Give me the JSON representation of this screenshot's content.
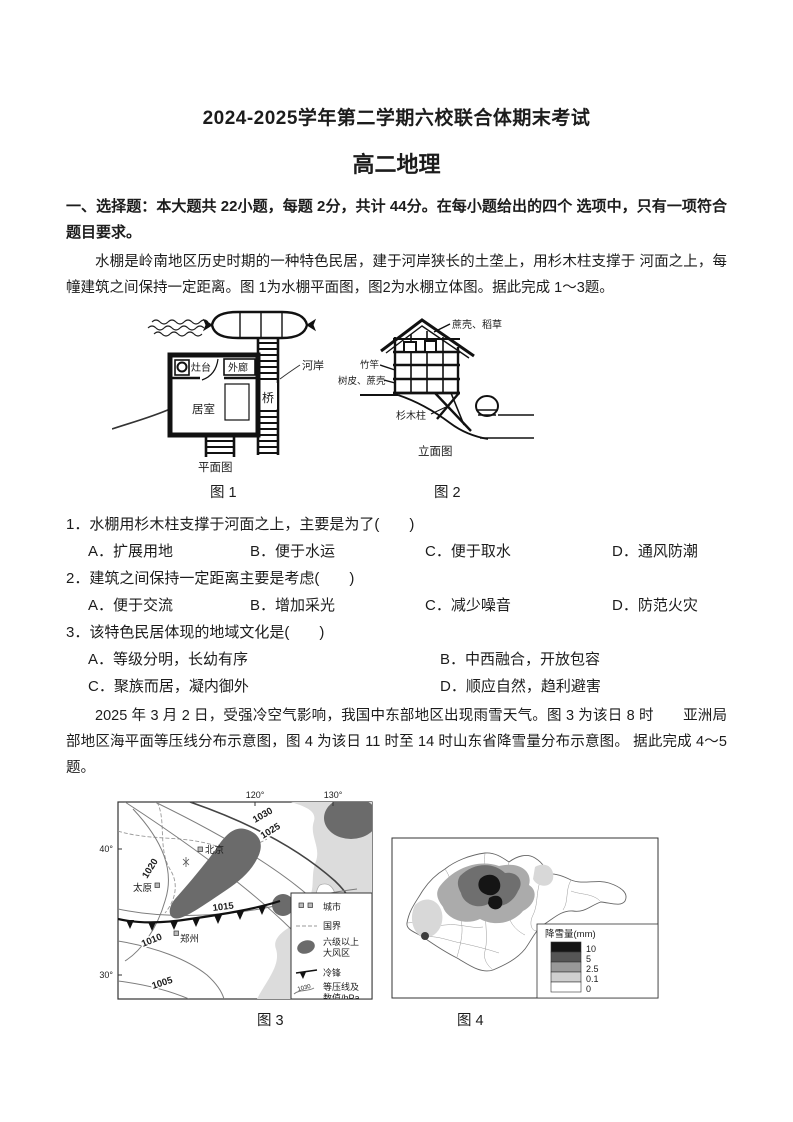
{
  "header": {
    "title": "2024-2025学年第二学期六校联合体期末考试",
    "subtitle": "高二地理"
  },
  "section1": {
    "heading": "一、选择题：本大题共 22小题，每题 2分，共计 44分。在每小题给出的四个 选项中，只有一项符合题目要求。"
  },
  "passage1": "水棚是岭南地区历史时期的一种特色民居，建于河岸狭长的土垄上，用杉木柱支撑于  河面之上，每幢建筑之间保持一定距离。图 1为水棚平面图，图2为水棚立体图。据此完成 1～3题。",
  "figure1": {
    "caption": "图 1",
    "label_stove": "灶台",
    "label_corridor": "外廊",
    "label_room": "居室",
    "label_riverbank": "河岸",
    "label_bridge": "桥",
    "label_view": "平面图"
  },
  "figure2": {
    "caption": "图 2",
    "label_roof": "蔗壳、稻草",
    "label_pole": "竹竿",
    "label_wall": "树皮、蔗壳",
    "label_column": "杉木柱",
    "label_view": "立面图"
  },
  "questions": [
    {
      "stem": "1．水棚用杉木柱支撑于河面之上，主要是为了(　　)",
      "options": [
        "A．扩展用地",
        "B．便于水运",
        "C．便于取水",
        "D．通风防潮"
      ]
    },
    {
      "stem": "2．建筑之间保持一定距离主要是考虑(　　)",
      "options": [
        "A．便于交流",
        "B．增加采光",
        "C．减少噪音",
        "D．防范火灾"
      ]
    },
    {
      "stem": "3．该特色民居体现的地域文化是(　　)",
      "options": [
        "A．等级分明，长幼有序",
        "B．中西融合，开放包容",
        "C．聚族而居，凝内御外",
        "D．顺应自然，趋利避害"
      ]
    }
  ],
  "passage2": "2025 年 3 月 2 日，受强冷空气影响，我国中东部地区出现雨雪天气。图 3 为该日 8 时　　亚洲局部地区海平面等压线分布示意图，图 4 为该日 11 时至 14 时山东省降雪量分布示意图。 据此完成 4～5题。",
  "figure3": {
    "caption": "图 3",
    "lon_ticks": [
      "120°",
      "130°"
    ],
    "lat_ticks": [
      "40°",
      "30°"
    ],
    "isobars": [
      "1030",
      "1025",
      "1020",
      "1015",
      "1010",
      "1005"
    ],
    "cities": [
      "北京",
      "太原",
      "郑州"
    ],
    "legend": {
      "city": "城市",
      "border": "国界",
      "gale_1": "六级以上",
      "gale_2": "大风区",
      "cold_front": "冷锋",
      "isobar_1": "等压线及",
      "isobar_2": "数值/hPa",
      "isobar_sample": "1030"
    }
  },
  "figure4": {
    "caption": "图 4",
    "legend_title": "降雪量(mm)",
    "legend_values": [
      "10",
      "5",
      "2.5",
      "0.1",
      "0"
    ]
  }
}
